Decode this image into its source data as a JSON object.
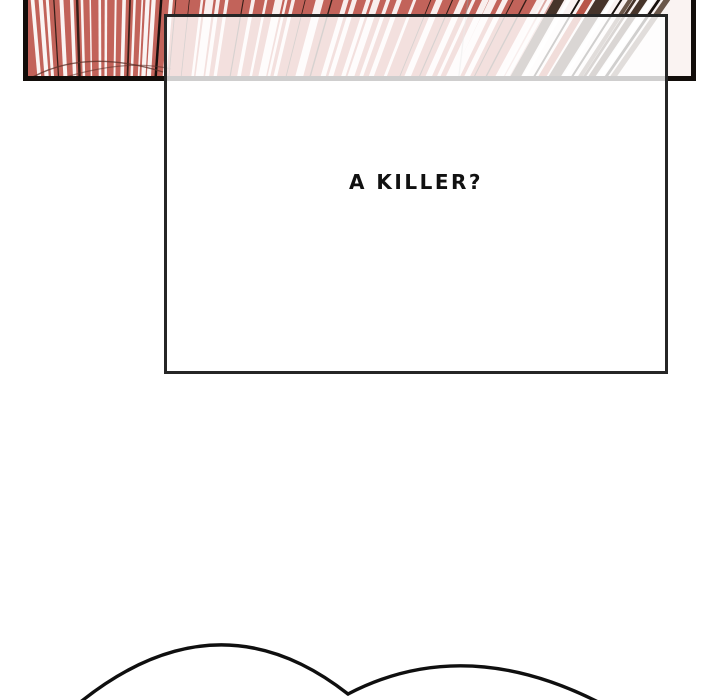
{
  "page": {
    "background_color": "#ffffff"
  },
  "panel": {
    "description": "speed-line-burst-panel",
    "base_color": "#c2635a",
    "border_color": "#120d0a",
    "dark_line_color": "#351e18",
    "black_line_color": "#17100d",
    "white_line_color": "#ffffff",
    "brown_stripe_color": "#46342a",
    "brown_light_color": "#6b574a",
    "red_stripe_color": "#b85548",
    "arc_line_color": "#5d3028",
    "ghost_line_color": "#9a9a9a"
  },
  "caption_box": {
    "text": "A KILLER?",
    "text_color": "#111111",
    "border_color": "#262626"
  },
  "bubble": {
    "stroke_color": "#0f0f0f"
  }
}
